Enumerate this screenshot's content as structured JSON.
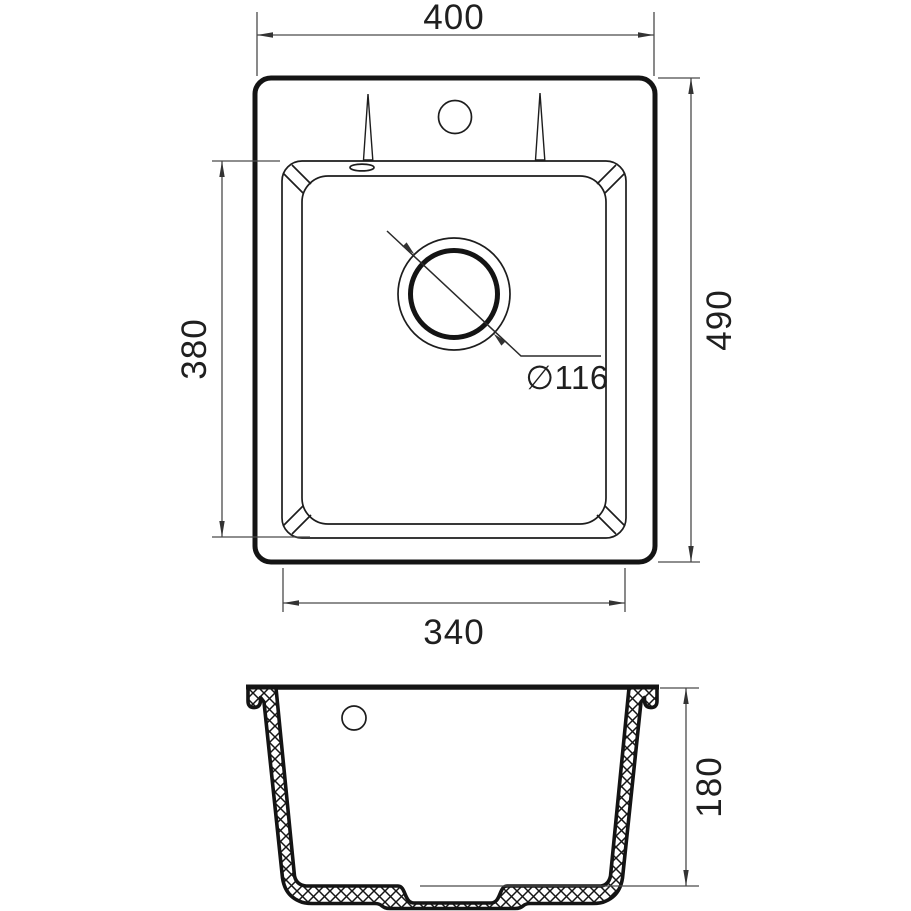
{
  "drawing": {
    "top_view": {
      "width_label": "400",
      "depth_label": "490",
      "bowl_width_label": "340",
      "bowl_depth_label": "380",
      "drain_diameter_label": "∅116"
    },
    "section_view": {
      "height_label": "180"
    },
    "colors": {
      "line": "#1d1d1d",
      "thick_line": "#141414",
      "dimension_line": "#4a4a4a",
      "text": "#1f1f1f",
      "background": "#ffffff"
    }
  }
}
